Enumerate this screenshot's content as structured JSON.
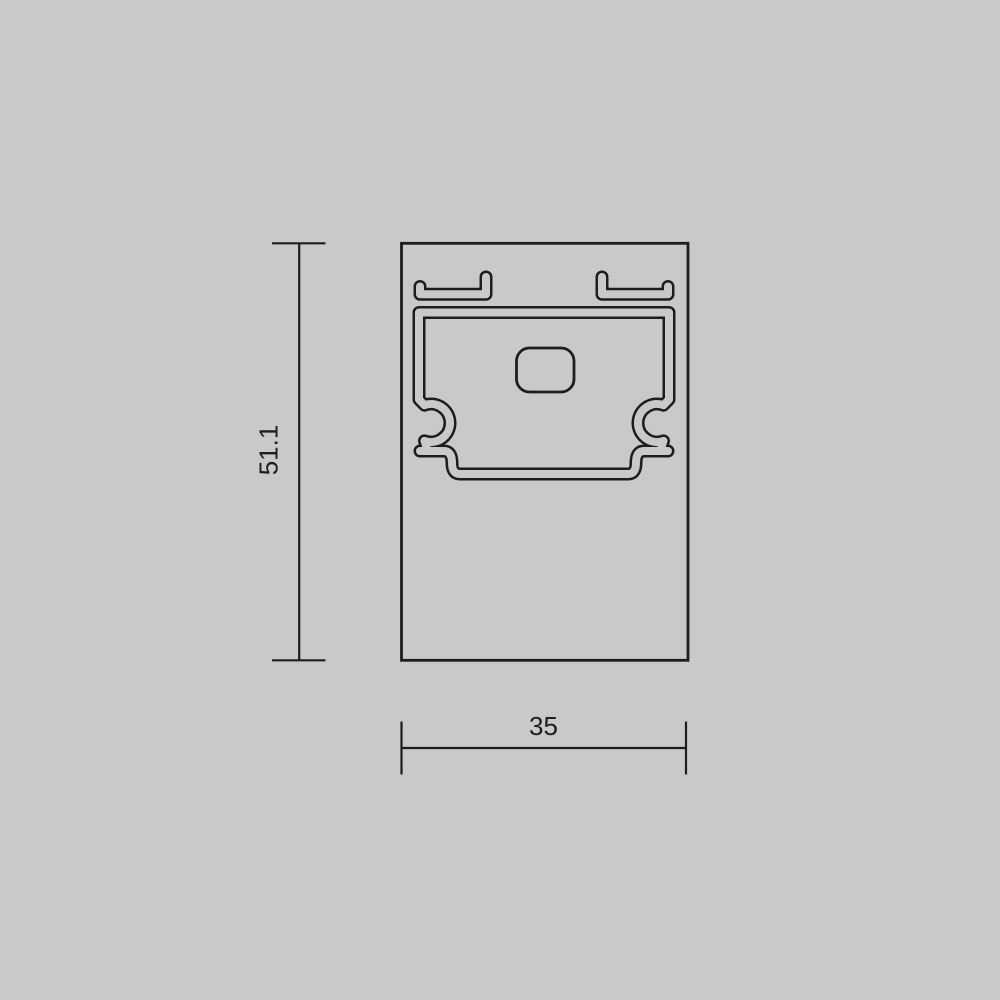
{
  "meta": {
    "background_color": "#c9c9c9",
    "line_color": "#1d1d1d",
    "drawing_kind": "profile-cross-section-technical-drawing"
  },
  "drawing": {
    "height_dimension": {
      "value": "51.1"
    },
    "width_dimension": {
      "value": "35"
    }
  }
}
